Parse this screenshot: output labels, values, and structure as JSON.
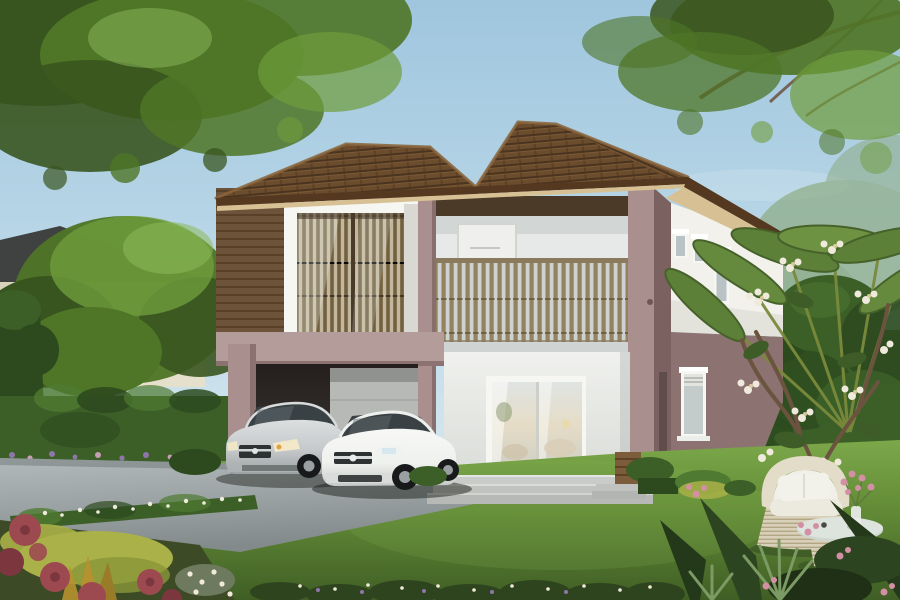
{
  "scene": {
    "type": "architectural-exterior-rendering",
    "description": "3D rendering of a modern two-story suburban house with a brown hip tile roof, mauve and white walls, a wood-slat balcony with bistro furniture, a box bay window with timber screens, a carport sheltering a silver sedan and a white sedan, wide front steps, a sliding glass door, green lawn, trimmed hedges, flower beds, a frangipani tree, a travelers palm, and white wicker garden furniture, framed by overhanging tree canopies under a blue sky.",
    "objects": [
      "sky",
      "tree-canopy-left",
      "tree-canopy-right",
      "neighbor-house",
      "garden-tree",
      "boundary-hedge",
      "bamboo-fence",
      "tiled-roof",
      "box-window",
      "balcony",
      "balcony-railing",
      "bistro-set",
      "corner-column",
      "tower-windows",
      "side-window",
      "carport",
      "garage-panel",
      "silver-sedan",
      "white-sedan",
      "sliding-glass-door",
      "front-steps",
      "corner-steps",
      "wooden-crate",
      "driveway",
      "lawn",
      "flower-bed",
      "white-flower-hedge",
      "right-hedge",
      "frangipani-tree",
      "travelers-palm",
      "wicker-armchair",
      "wicker-coffee-table",
      "flower-vase",
      "foreground-plants"
    ]
  },
  "colors": {
    "sky_top": "#9fc6de",
    "sky_mid": "#c2dcea",
    "sky_horizon": "#e8f2f4",
    "foliage_dark": "#39551f",
    "foliage_mid": "#4f7527",
    "foliage_bright": "#6f9c3c",
    "foliage_light": "#8cb95a",
    "branch": "#6a4a33",
    "distant_green": "#8aa87c",
    "neighbor_roof": "#3f4240",
    "neighbor_wall": "#e6dfc8",
    "hedge_dark": "#2c4a1e",
    "hedge_mid": "#3c5f28",
    "hedge_light": "#4f7a31",
    "roof_dark": "#4a3420",
    "roof_mid": "#6b4c2c",
    "roof_light": "#8a653c",
    "fascia": "#54381f",
    "soffit": "#d7c194",
    "mauve": "#a98f8d",
    "mauve_light": "#b49c9a",
    "mauve_dark": "#8c7271",
    "mauve_deep": "#7b6160",
    "siding": "#6d5339",
    "siding_dark": "#594127",
    "white_wall": "#ecedeb",
    "white_shade": "#d7dbd9",
    "cream": "#f2f1ec",
    "frame_white": "#f6f6f3",
    "glass_cool": "#ccd6d8",
    "glass_warm": "#e5dcc6",
    "slat": "#94815f",
    "slat_dark": "#73603f",
    "railing_bg": "#ccd2d1",
    "carport_dark": "#332f2c",
    "garage": "#b6b9b6",
    "drive": "#9ba3a4",
    "drive_dark": "#828a8b",
    "drive_light": "#b3babb",
    "grass": "#628a36",
    "grass_light": "#7ca84a",
    "grass_dark": "#3f5e25",
    "step": "#c8cbc7",
    "car_silver": "#c6c9cb",
    "car_silver_dk": "#9ba1a2",
    "car_glass": "#3a4145",
    "car_white": "#eff1ee",
    "tire": "#17191b",
    "hub": "#9aa0a2",
    "grille": "#2e3233",
    "headlight": "#f3e9c8",
    "crate": "#7c5c3a",
    "crate_dark": "#5d4228",
    "wicker": "#d9d0ba",
    "wicker_dark": "#b3a684",
    "cushion": "#f0efe8",
    "flower_red": "#9c4a50",
    "flower_red_dark": "#7c363e",
    "bush_yellow": "#a9b148",
    "croton": "#b5912f",
    "flower_white": "#efeadb",
    "flower_pink": "#d38fa4",
    "flower_purple": "#8f76a8"
  }
}
